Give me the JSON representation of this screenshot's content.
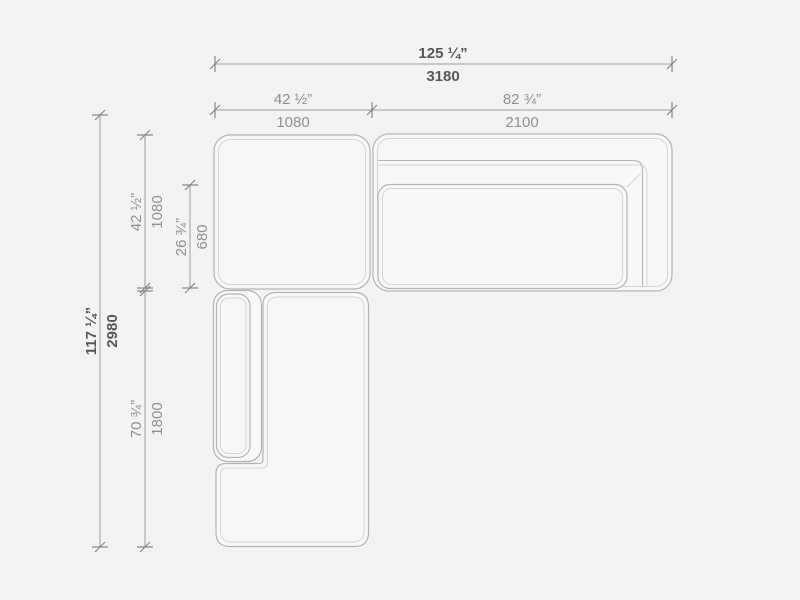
{
  "drawing": {
    "background_color": "#f3f3f3",
    "outline_color": "#b3b3b3",
    "seam_color": "#d4d4d4",
    "dimension_line_color": "#9e9e9e",
    "secondary_label_color": "#8f8f8f",
    "primary_label_color": "#565656"
  },
  "dimensions": {
    "overall_width": {
      "imperial": "125 ¼”",
      "metric": "3180"
    },
    "module_left_width": {
      "imperial": "42 ½”",
      "metric": "1080"
    },
    "module_right_width": {
      "imperial": "82 ¾”",
      "metric": "2100"
    },
    "overall_depth": {
      "imperial": "117 ¼”",
      "metric": "2980"
    },
    "corner_module_depth": {
      "imperial": "42 ½”",
      "metric": "1080"
    },
    "seat_depth": {
      "imperial": "26 ¾”",
      "metric": "680"
    },
    "chaise_depth": {
      "imperial": "70 ¾”",
      "metric": "1800"
    }
  }
}
